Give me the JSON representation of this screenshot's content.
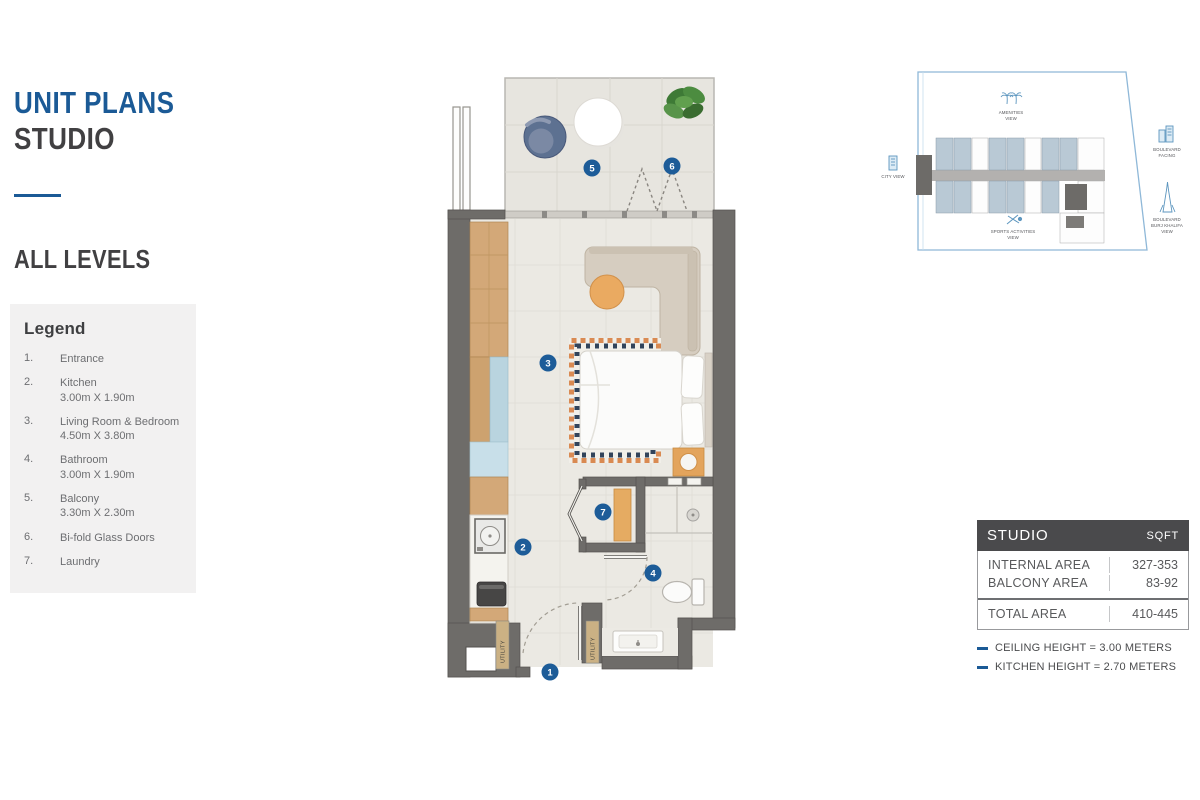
{
  "header": {
    "title_line1": "UNIT PLANS",
    "title_line2": "STUDIO",
    "section": "ALL LEVELS"
  },
  "legend": {
    "title": "Legend",
    "items": [
      {
        "num": "1.",
        "name": "Entrance",
        "dims": ""
      },
      {
        "num": "2.",
        "name": "Kitchen",
        "dims": "3.00m X 1.90m"
      },
      {
        "num": "3.",
        "name": "Living Room & Bedroom",
        "dims": "4.50m X 3.80m"
      },
      {
        "num": "4.",
        "name": "Bathroom",
        "dims": "3.00m X 1.90m"
      },
      {
        "num": "5.",
        "name": "Balcony",
        "dims": "3.30m X 2.30m"
      },
      {
        "num": "6.",
        "name": "Bi-fold Glass Doors",
        "dims": ""
      },
      {
        "num": "7.",
        "name": "Laundry",
        "dims": ""
      }
    ]
  },
  "plan": {
    "markers": [
      "1",
      "2",
      "3",
      "4",
      "5",
      "6",
      "7"
    ],
    "utility_label": "UTILITY"
  },
  "keyplan": {
    "labels": {
      "amenities": [
        "AMENITIES",
        "VIEW"
      ],
      "city": "CITY VIEW",
      "sports": [
        "SPORTS ACTIVITIES",
        "VIEW"
      ],
      "boulevard_facing": [
        "BOULEVARD",
        "FACING"
      ],
      "burj": [
        "BOULEVARD",
        "BURJ KHALIFA",
        "VIEW"
      ]
    }
  },
  "area_table": {
    "header_left": "STUDIO",
    "header_right": "SQFT",
    "rows": [
      {
        "label": "INTERNAL AREA",
        "value": "327-353"
      },
      {
        "label": "BALCONY AREA",
        "value": "83-92"
      }
    ],
    "total": {
      "label": "TOTAL AREA",
      "value": "410-445"
    }
  },
  "notes": [
    {
      "text": "CEILING HEIGHT = 3.00 METERS"
    },
    {
      "text": "KITCHEN HEIGHT = 2.70 METERS"
    }
  ],
  "colors": {
    "accent_blue": "#1b5a96",
    "marker_blue": "#1d5c98",
    "wall_gray": "#6e6c69",
    "table_header": "#4a4a4c"
  }
}
